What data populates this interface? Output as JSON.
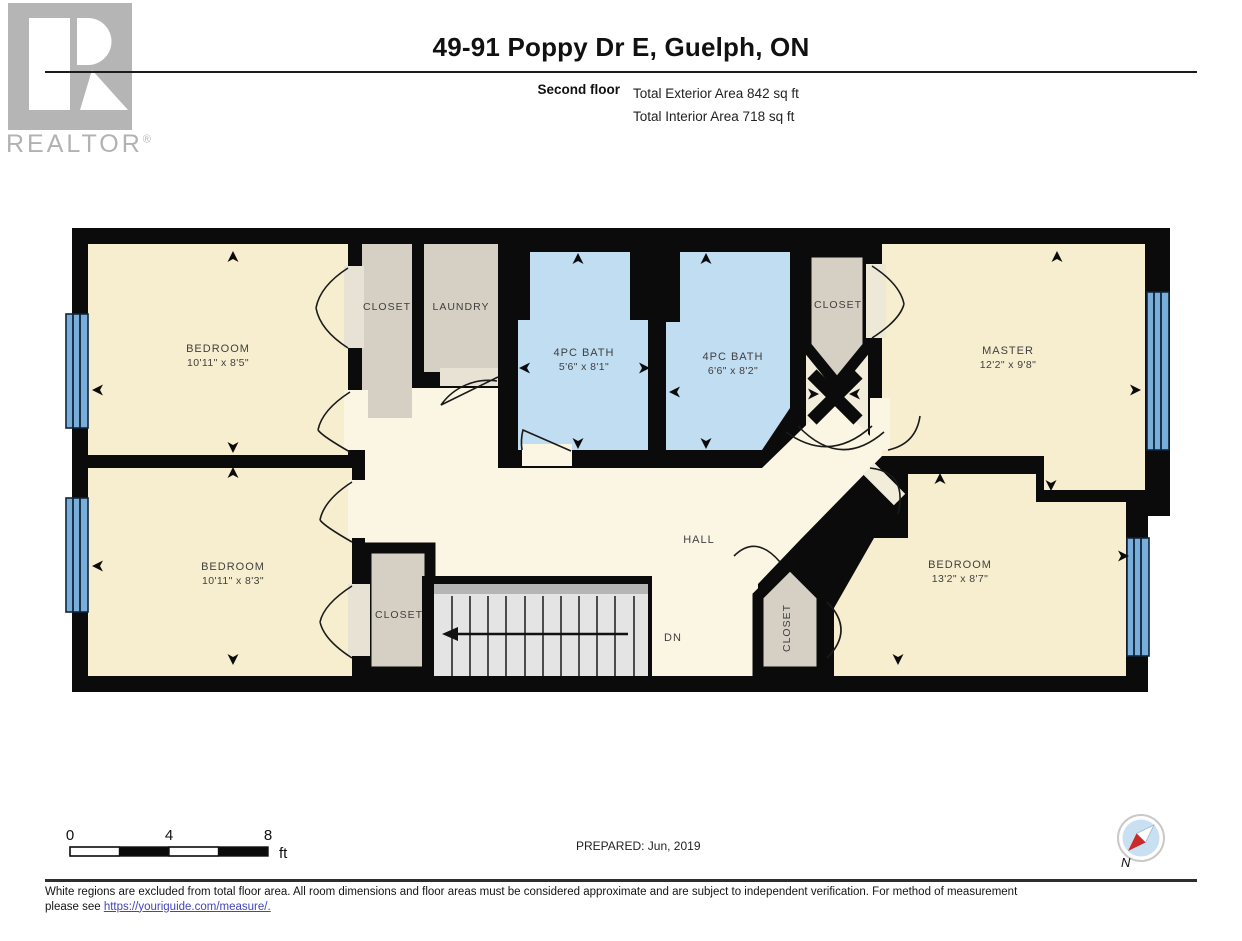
{
  "header": {
    "title": "49-91 Poppy Dr E, Guelph, ON",
    "floor_label": "Second floor",
    "total_exterior": "Total Exterior Area 842 sq ft",
    "total_interior": "Total Interior Area 718 sq ft",
    "logo": {
      "text": "REALTOR",
      "reg": "®"
    }
  },
  "plan": {
    "rooms": [
      {
        "id": "bedroom-top-left",
        "label": "BEDROOM",
        "dims": "10'11\" x 8'5\""
      },
      {
        "id": "closet-top",
        "label": "CLOSET",
        "dims": ""
      },
      {
        "id": "laundry",
        "label": "LAUNDRY",
        "dims": ""
      },
      {
        "id": "bath-1",
        "label": "4PC BATH",
        "dims": "5'6\" x 8'1\""
      },
      {
        "id": "bath-2",
        "label": "4PC BATH",
        "dims": "6'6\" x 8'2\""
      },
      {
        "id": "closet-master",
        "label": "CLOSET",
        "dims": ""
      },
      {
        "id": "master",
        "label": "MASTER",
        "dims": "12'2\" x 9'8\""
      },
      {
        "id": "bedroom-bottom-left",
        "label": "BEDROOM",
        "dims": "10'11\" x 8'3\""
      },
      {
        "id": "closet-bottom",
        "label": "CLOSET",
        "dims": ""
      },
      {
        "id": "hall",
        "label": "HALL",
        "dims": ""
      },
      {
        "id": "closet-hall",
        "label": "CLOSET",
        "dims": ""
      },
      {
        "id": "bedroom-bottom-right",
        "label": "BEDROOM",
        "dims": "13'2\" x 8'7\""
      }
    ],
    "stairs": {
      "dn_label": "DN"
    }
  },
  "scale_bar": {
    "tick0": "0",
    "tick4": "4",
    "tick8": "8",
    "unit": "ft"
  },
  "compass": {
    "north_label": "N"
  },
  "prepared": "PREPARED: Jun, 2019",
  "disclaimer": {
    "line1": "White regions are excluded from total floor area. All room dimensions and floor areas must be considered approximate and are subject to independent verification. For method of measurement",
    "line2_prefix": "please see ",
    "link_text": "https://youriguide.com/measure/."
  },
  "colors": {
    "wall": "#0b0b0b",
    "bedroom_fill": "#f7eed0",
    "hall_fill": "#fbf6e3",
    "bath_fill": "#c1ddf1",
    "closet_fill": "#d6cfc3",
    "window_fill": "#79aedb",
    "compass_red": "#cc2a2a"
  }
}
